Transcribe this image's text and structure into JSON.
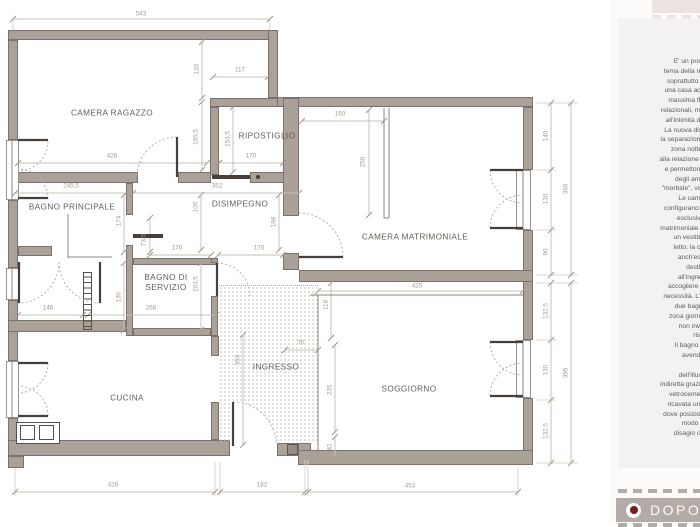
{
  "rooms": {
    "camera_ragazzo": "CAMERA RAGAZZO",
    "ripostiglio": "RIPOSTIGLIO",
    "bagno_principale": "BAGNO PRINCIPALE",
    "disimpegno": "DISIMPEGNO",
    "camera_matrimoniale": "CAMERA MATRIMONIALE",
    "bagno_di_servizio": "BAGNO DI SERVIZIO",
    "cucina": "CUCINA",
    "ingresso": "INGRESSO",
    "soggiorno": "SOGGIORNO"
  },
  "dims": [
    "543",
    "130",
    "165,5",
    "117",
    "153,5",
    "426",
    "170",
    "245,5",
    "352",
    "100",
    "174",
    "198",
    "73,5",
    "170",
    "170",
    "203,5",
    "130",
    "146",
    "268",
    "160",
    "250",
    "425",
    "118",
    "70",
    "353",
    "235",
    "42",
    "426",
    "182",
    "453",
    "140",
    "130",
    "90",
    "360",
    "132,5",
    "130",
    "132,5",
    "395"
  ],
  "sidebar": {
    "text": "E' un prog\ntema della rel\nsoprattutto q\nuna casa acc\nmassima flu\nrelazionali, ma\nall'intimità de\nLa nuova dist\nla separazione\nzona notte.\nalla relazione s\ne permettono\ndegli amb\n\"morbide\", visi\nLe came\nconfigurano c\nesclusivi,\nmatrimoniale è\nun vestibo\nletto; la ca\nanch'ess\ndestin\nall'ingres\naccogliere u\nnecessità. L'a\ndue bagni\nzona giorno\nnon inva\nrise\nIl bagno d\navendo\n\ndell'illum\nindiretta grazie\nvetrocemen\nricavata una\ndove posizion\nmodo d\ndisagio co",
    "label": "DOPO"
  },
  "colors": {
    "wall": "#aaa198",
    "accent_red": "#7a1b1b",
    "dopo_bar": "#b3aba5",
    "panel": "#f4f2f1",
    "tab_pink": "#ece2df"
  }
}
